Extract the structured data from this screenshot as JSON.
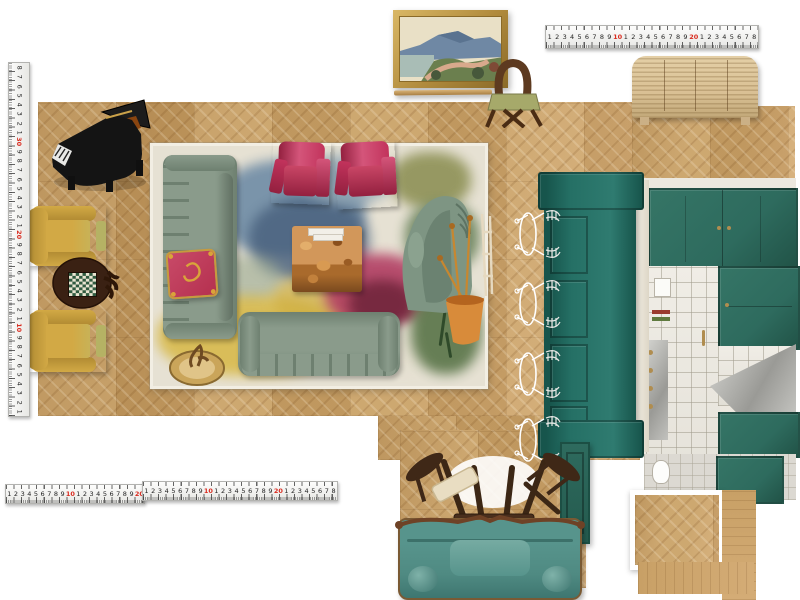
{
  "colors": {
    "floor1": "#c8a066",
    "floor2": "#b68c52",
    "floor3": "#d4ac76",
    "ruler_red": "#d92b1f",
    "ruler_ink": "#222222",
    "rug_base": "#e6e1d3",
    "sage": "#8a9b8b",
    "sage_dark": "#6e8070",
    "pillow": "#b5304f",
    "gold": "#c79a3d",
    "pinkchair": "#c2335c",
    "pinkchair_dark": "#93203f",
    "mustard": "#d2a945",
    "mustard_dark": "#b08a32",
    "burl_dark": "#7a4a1e",
    "chaise": "#7e9583",
    "teal_island": "#257065",
    "teal_island_dark": "#17554c",
    "kitchen_green": "#2e6b5e",
    "brass": "#b08d4f",
    "walnut": "#46301d",
    "teal_sofa": "#57948c",
    "teal_sofa_dark": "#3e7670",
    "frame_gold": "#b08a3c",
    "sideboard": "#d9c094",
    "piano_black": "#151515"
  },
  "rulers": {
    "top": [
      "1",
      "2",
      "3",
      "4",
      "5",
      "6",
      "7",
      "8",
      "9",
      "10",
      "1",
      "2",
      "3",
      "4",
      "5",
      "6",
      "7",
      "8",
      "9",
      "20",
      "1",
      "2",
      "3",
      "4",
      "5",
      "6",
      "7",
      "8"
    ],
    "bottom_a": [
      "1",
      "2",
      "3",
      "4",
      "5",
      "6",
      "7",
      "8",
      "9",
      "10",
      "1",
      "2",
      "3",
      "4",
      "5",
      "6",
      "7",
      "8",
      "9",
      "20"
    ],
    "bottom_b": [
      "1",
      "2",
      "3",
      "4",
      "5",
      "6",
      "7",
      "8",
      "9",
      "10",
      "1",
      "2",
      "3",
      "4",
      "5",
      "6",
      "7",
      "8",
      "9",
      "20",
      "1",
      "2",
      "3",
      "4",
      "5",
      "6",
      "7",
      "8"
    ],
    "left": [
      "8",
      "7",
      "6",
      "5",
      "4",
      "3",
      "2",
      "1",
      "30",
      "9",
      "8",
      "7",
      "6",
      "5",
      "4",
      "3",
      "2",
      "1",
      "20",
      "9",
      "8",
      "7",
      "6",
      "5",
      "4",
      "3",
      "2",
      "1",
      "10",
      "9",
      "8",
      "7",
      "6",
      "5",
      "4",
      "3",
      "2",
      "1"
    ]
  },
  "furniture": [
    {
      "name": "grand-piano",
      "color": "#151515"
    },
    {
      "name": "framed-landscape-painting",
      "frame": "#b08a3c"
    },
    {
      "name": "picture-rail-rod",
      "color": "#c8a066"
    },
    {
      "name": "loop-back-dining-chair",
      "wood": "#5d3a20",
      "seat": "#a6a96a"
    },
    {
      "name": "slatted-sideboard",
      "color": "#d9c094"
    },
    {
      "name": "armchair-yellow",
      "count": 2,
      "color": "#d2a945"
    },
    {
      "name": "games-table-checkerboard",
      "color": "#3a2113"
    },
    {
      "name": "floral-abstract-rug",
      "base": "#e6e1d3"
    },
    {
      "name": "sofa-sage-vertical",
      "color": "#8a9b8b"
    },
    {
      "name": "sofa-sage-horizontal",
      "color": "#8a9b8b"
    },
    {
      "name": "tasseled-pillow",
      "color": "#b5304f"
    },
    {
      "name": "armchair-magenta",
      "count": 2,
      "color": "#c2335c"
    },
    {
      "name": "burl-coffee-table",
      "color": "#c08044"
    },
    {
      "name": "curved-chaise-green",
      "color": "#7e9583"
    },
    {
      "name": "potted-plant-terracotta",
      "pot": "#d88b3a"
    },
    {
      "name": "brass-side-table-with-figurine",
      "color": "#b08d4f"
    },
    {
      "name": "kitchen-island-teal",
      "color": "#257065"
    },
    {
      "name": "wire-bar-stool",
      "count": 4,
      "color": "#ffffff"
    },
    {
      "name": "kitchen-elevation-photo",
      "cabinet": "#2e6b5e",
      "tile": "#eae7df",
      "hood": "#b9b9b5"
    },
    {
      "name": "green-door-panel",
      "color": "#2e6b5e"
    },
    {
      "name": "teal-sofa-carved-trim",
      "color": "#57948c"
    },
    {
      "name": "stacked-dark-wood-tables-chairs",
      "color": "#46301d"
    },
    {
      "name": "floor-sample-chevron",
      "color": "#c8a066"
    },
    {
      "name": "floor-sample-planks-L",
      "color": "#c49a62"
    }
  ]
}
